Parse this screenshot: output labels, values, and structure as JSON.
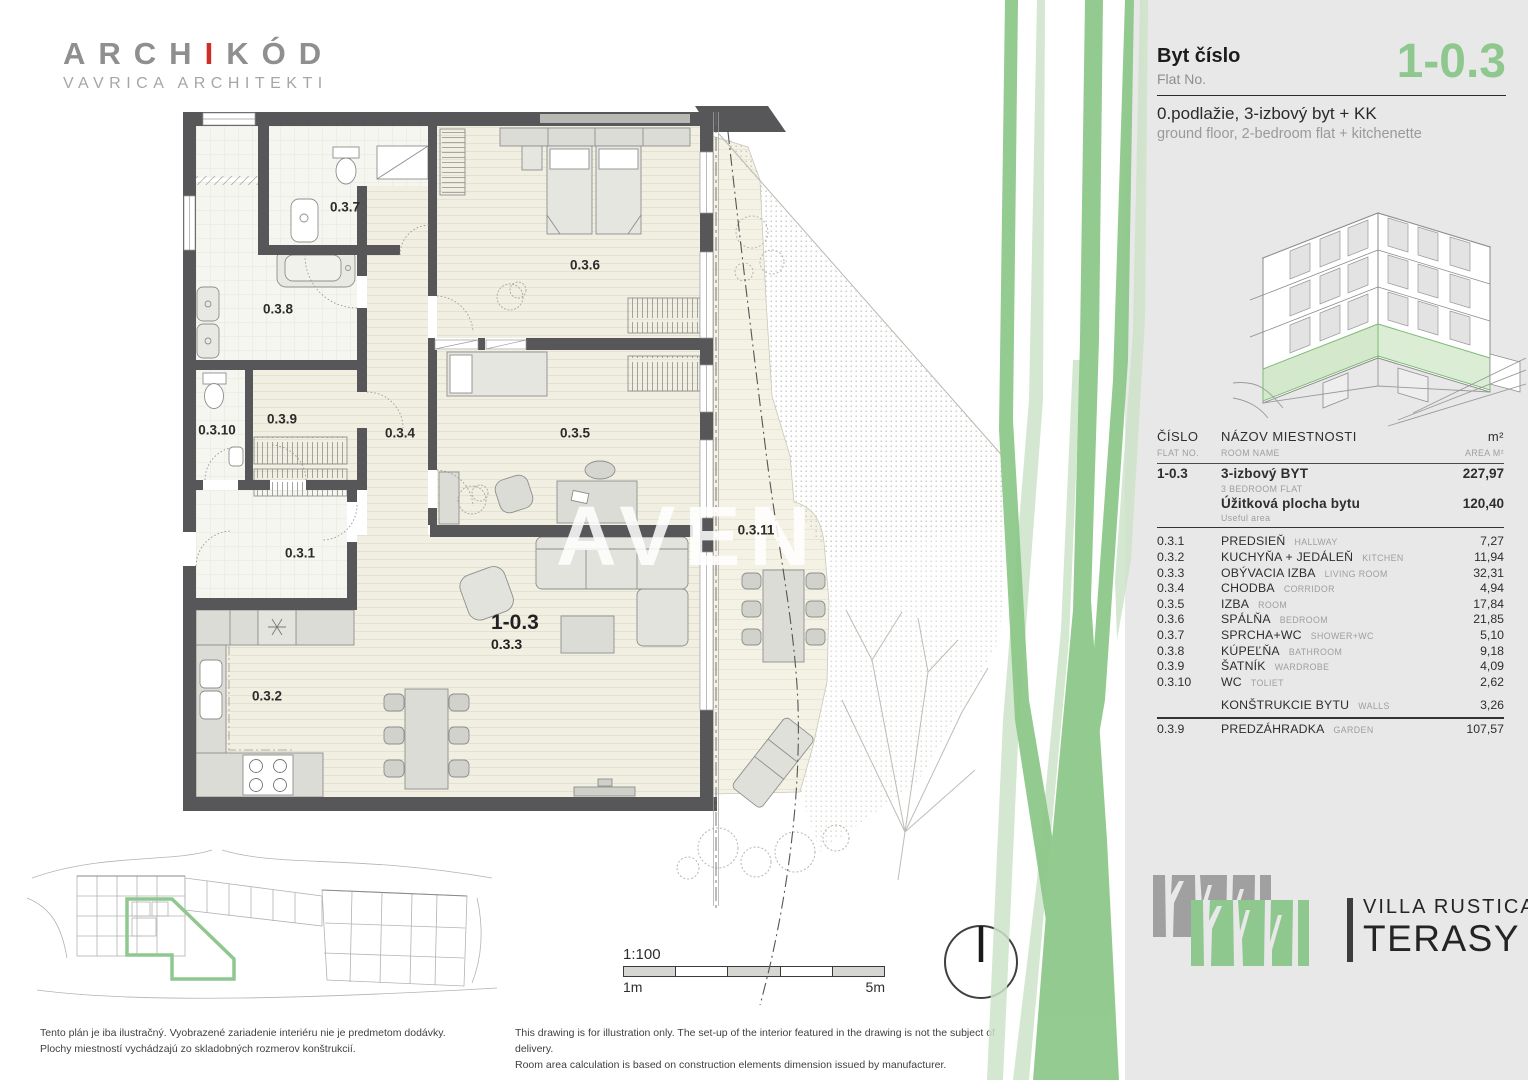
{
  "branding": {
    "archikod_part1": "ARCH",
    "archikod_accent": "I",
    "archikod_part2": "KÓD",
    "archikod_subtitle": "VAVRICA ARCHITEKTI",
    "villa_line1": "VILLA RUSTICA",
    "villa_line2": "TERASY"
  },
  "header": {
    "flat_label_sk": "Byt číslo",
    "flat_label_en": "Flat No.",
    "flat_number": "1-0.3",
    "desc_sk": "0.podlažie, 3-izbový byt + KK",
    "desc_en": "ground floor, 2-bedroom flat + kitchenette"
  },
  "table": {
    "headers": {
      "col1_sk": "ČÍSLO",
      "col1_en": "FLAT NO.",
      "col2_sk": "NÁZOV  MIESTNOSTI",
      "col2_en": "ROOM NAME",
      "col3_sk": "m²",
      "col3_en": "AREA M²"
    },
    "summary": {
      "flat_no": "1-0.3",
      "row1_sk": "3-izbový BYT",
      "row1_en": "3 BEDROOM FLAT",
      "row1_area": "227,97",
      "row2_sk": "Úžitková plocha bytu",
      "row2_en": "Useful area",
      "row2_area": "120,40"
    },
    "rooms": [
      {
        "no": "0.3.1",
        "name": "PREDSIEŇ",
        "name_en": "HALLWAY",
        "area": "7,27"
      },
      {
        "no": "0.3.2",
        "name": "KUCHYŇA + JEDÁLEŇ",
        "name_en": "KITCHEN",
        "area": "11,94"
      },
      {
        "no": "0.3.3",
        "name": "OBÝVACIA IZBA",
        "name_en": "LIVING ROOM",
        "area": "32,31"
      },
      {
        "no": "0.3.4",
        "name": "CHODBA",
        "name_en": "CORRIDOR",
        "area": "4,94"
      },
      {
        "no": "0.3.5",
        "name": "IZBA",
        "name_en": "ROOM",
        "area": "17,84"
      },
      {
        "no": "0.3.6",
        "name": "SPÁLŇA",
        "name_en": "BEDROOM",
        "area": "21,85"
      },
      {
        "no": "0.3.7",
        "name": "SPRCHA+WC",
        "name_en": "SHOWER+WC",
        "area": "5,10"
      },
      {
        "no": "0.3.8",
        "name": "KÚPEĽŇA",
        "name_en": "BATHROOM",
        "area": "9,18"
      },
      {
        "no": "0.3.9",
        "name": "ŠATNÍK",
        "name_en": "WARDROBE",
        "area": "4,09"
      },
      {
        "no": "0.3.10",
        "name": "WC",
        "name_en": "TOLIET",
        "area": "2,62"
      }
    ],
    "walls_row": {
      "no": "",
      "name": "KONŠTRUKCIE BYTU",
      "name_en": "WALLS",
      "area": "3,26"
    },
    "garden_row": {
      "no": "0.3.9",
      "name": "PREDZÁHRADKA",
      "name_en": "GARDEN",
      "area": "107,57"
    }
  },
  "plan": {
    "watermark": "AVEN",
    "unit_label": "1-0.3",
    "unit_room": "0.3.3",
    "labels": [
      {
        "text": "0.3.7",
        "x": 345,
        "y": 207
      },
      {
        "text": "0.3.6",
        "x": 585,
        "y": 265
      },
      {
        "text": "0.3.8",
        "x": 278,
        "y": 309
      },
      {
        "text": "0.3.9",
        "x": 282,
        "y": 419
      },
      {
        "text": "0.3.10",
        "x": 217,
        "y": 430
      },
      {
        "text": "0.3.4",
        "x": 400,
        "y": 433
      },
      {
        "text": "0.3.5",
        "x": 575,
        "y": 433
      },
      {
        "text": "0.3.1",
        "x": 300,
        "y": 553
      },
      {
        "text": "0.3.2",
        "x": 267,
        "y": 696
      },
      {
        "text": "0.3.11",
        "x": 756,
        "y": 530
      }
    ]
  },
  "scalebar": {
    "ratio": "1:100",
    "from": "1m",
    "to": "5m"
  },
  "footer": {
    "sk_line1": "Tento plán je iba ilustračný. Vyobrazené zariadenie interiéru nie je predmetom dodávky.",
    "sk_line2": "Plochy miestností vychádzajú zo skladobných rozmerov konštrukcií.",
    "en_line1": "This drawing is for illustration only. The set-up of the interior featured in the drawing is not the subject of delivery.",
    "en_line2": "Room area calculation is based on construction elements dimension issued by manufacturer."
  },
  "colors": {
    "accent_green": "#8fc88f",
    "pale_green": "#cde3c8",
    "panel_gray": "#e8e8e8",
    "wall": "#57575a",
    "floor": "#f0efe2"
  }
}
